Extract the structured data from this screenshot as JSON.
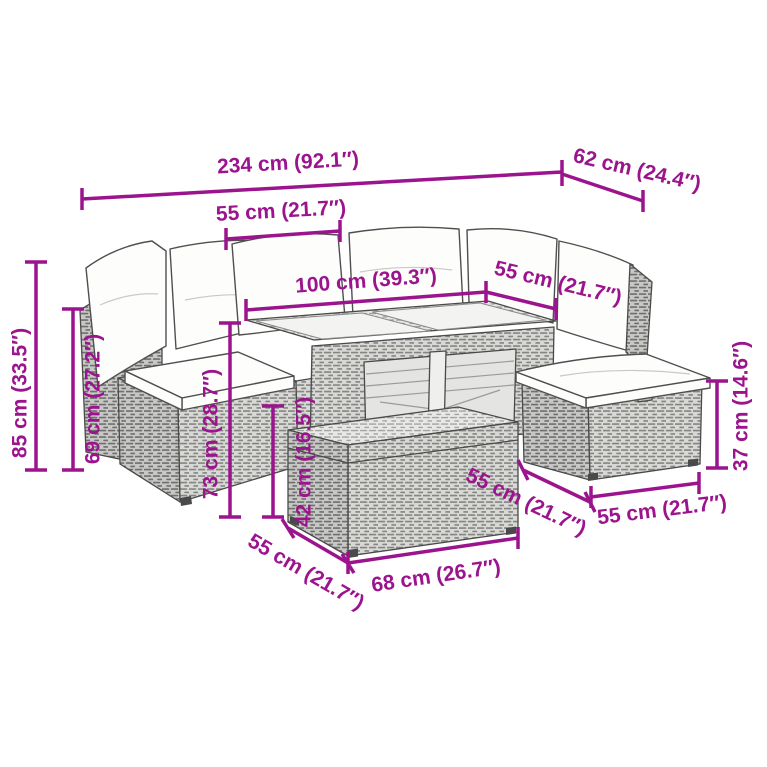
{
  "image_type": "product-dimension-diagram",
  "product": "rattan-garden-lounge-set-with-glass-top-table-and-stool",
  "accent_color": "#9B148E",
  "dims": {
    "total_width": {
      "label": "234 cm (92.1″)"
    },
    "side_depth": {
      "label": "62 cm (24.4″)"
    },
    "back_cushion_width": {
      "label": "55 cm (21.7″)"
    },
    "table_top_length": {
      "label": "100 cm (39.3″)"
    },
    "table_top_width": {
      "label": "55 cm (21.7″)"
    },
    "total_height": {
      "label": "85 cm (33.5″)"
    },
    "back_height": {
      "label": "69 cm (27.2″)"
    },
    "table_height": {
      "label": "73 cm (28.7″)"
    },
    "front_box_height": {
      "label": "42 cm (16.5″)"
    },
    "stool_height": {
      "label": "37 cm (14.6″)"
    },
    "stool_depth": {
      "label": "55 cm (21.7″)"
    },
    "stool_width": {
      "label": "55 cm (21.7″)"
    },
    "front_box_depth": {
      "label": "55 cm (21.7″)"
    },
    "front_box_width": {
      "label": "68 cm (26.7″)"
    }
  }
}
